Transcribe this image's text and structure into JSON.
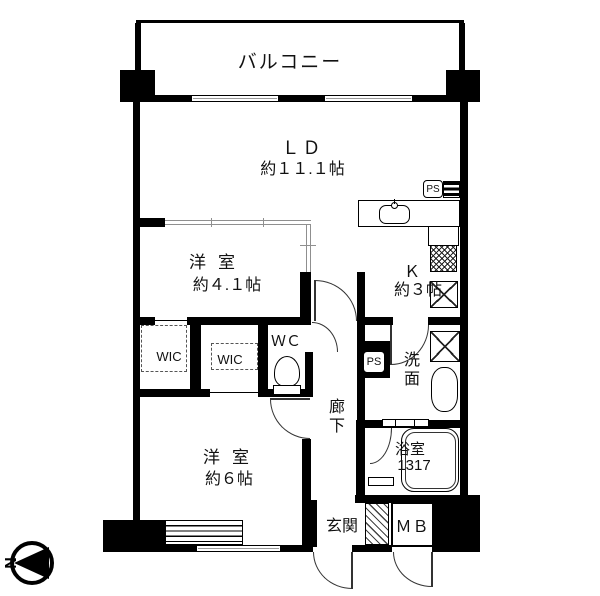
{
  "rooms": {
    "balcony": {
      "label": "バルコニー"
    },
    "living_dining": {
      "label": "ＬＤ",
      "size": "約１１.１帖"
    },
    "bedroom_small": {
      "label": "洋室",
      "size": "約４.１帖"
    },
    "bedroom_main": {
      "label": "洋室",
      "size": "約６帖"
    },
    "kitchen": {
      "label": "Ｋ",
      "size": "約３帖"
    },
    "wic_left": {
      "label": "WIC"
    },
    "wic_right": {
      "label": "WIC"
    },
    "toilet": {
      "label": "ＷＣ"
    },
    "washroom": {
      "label": "洗面"
    },
    "corridor": {
      "label": "廊下"
    },
    "bathroom": {
      "label": "浴室",
      "size": "1317"
    },
    "entrance": {
      "label": "玄関"
    },
    "meter_box": {
      "label": "ＭＢ"
    },
    "pipe_space_top": {
      "label": "PS"
    },
    "pipe_space_mid": {
      "label": "PS"
    }
  },
  "compass": {
    "north_label": "N"
  },
  "colors": {
    "wall": "#000000",
    "sliding_partition": "#8f8f8f",
    "window": "#9a9a9a",
    "background": "#ffffff"
  }
}
